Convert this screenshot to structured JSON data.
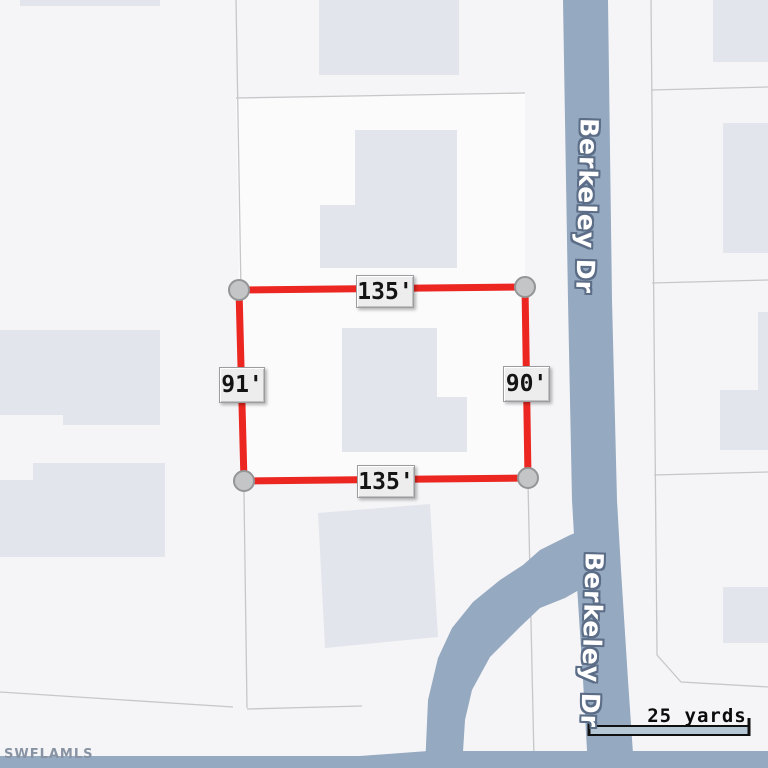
{
  "map": {
    "road_label": "Berkeley Dr",
    "watermark": "SWFLAMLS",
    "scale_bar": {
      "label": "25 yards"
    },
    "lot_dimensions": {
      "top": "135'",
      "right": "90'",
      "bottom": "135'",
      "left": "91'"
    },
    "colors": {
      "background": "#f5f5f7",
      "parcel_fill": "#fbfbfc",
      "parcel_line": "#c6c7c9",
      "building": "#e3e5ec",
      "road": "#95a9c0",
      "road_label_halo": "#5c6d87",
      "boundary_red": "#ec2620",
      "corner_fill": "#c4c5c7",
      "corner_stroke": "#939597",
      "scale_bar_fill": "#b5c7d4",
      "watermark_color": "#8793a3"
    }
  }
}
